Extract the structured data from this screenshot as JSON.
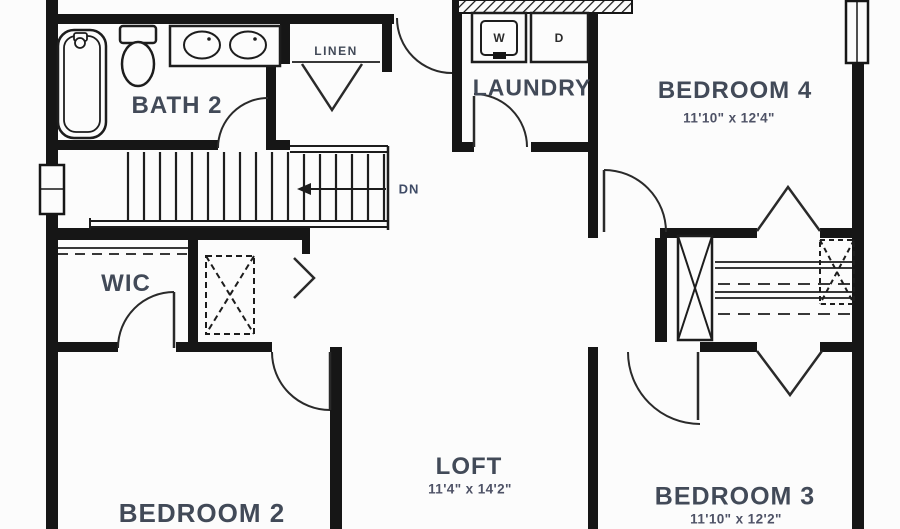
{
  "rooms": {
    "bath2": {
      "name": "BATH 2"
    },
    "linen": {
      "name": "LINEN"
    },
    "laundry": {
      "name": "LAUNDRY",
      "washer": "W",
      "dryer": "D"
    },
    "bedroom4": {
      "name": "BEDROOM 4",
      "dims": "11'10\" x 12'4\""
    },
    "wic": {
      "name": "WIC"
    },
    "bedroom2": {
      "name": "BEDROOM 2"
    },
    "loft": {
      "name": "LOFT",
      "dims": "11'4\" x 14'2\""
    },
    "bedroom3": {
      "name": "BEDROOM 3",
      "dims": "11'10\" x 12'2\""
    },
    "stairs": {
      "direction": "DN"
    }
  },
  "colors": {
    "wall": "#161616",
    "label": "#424a58",
    "dims": "#4e5266",
    "background": "#fcfcfc"
  }
}
